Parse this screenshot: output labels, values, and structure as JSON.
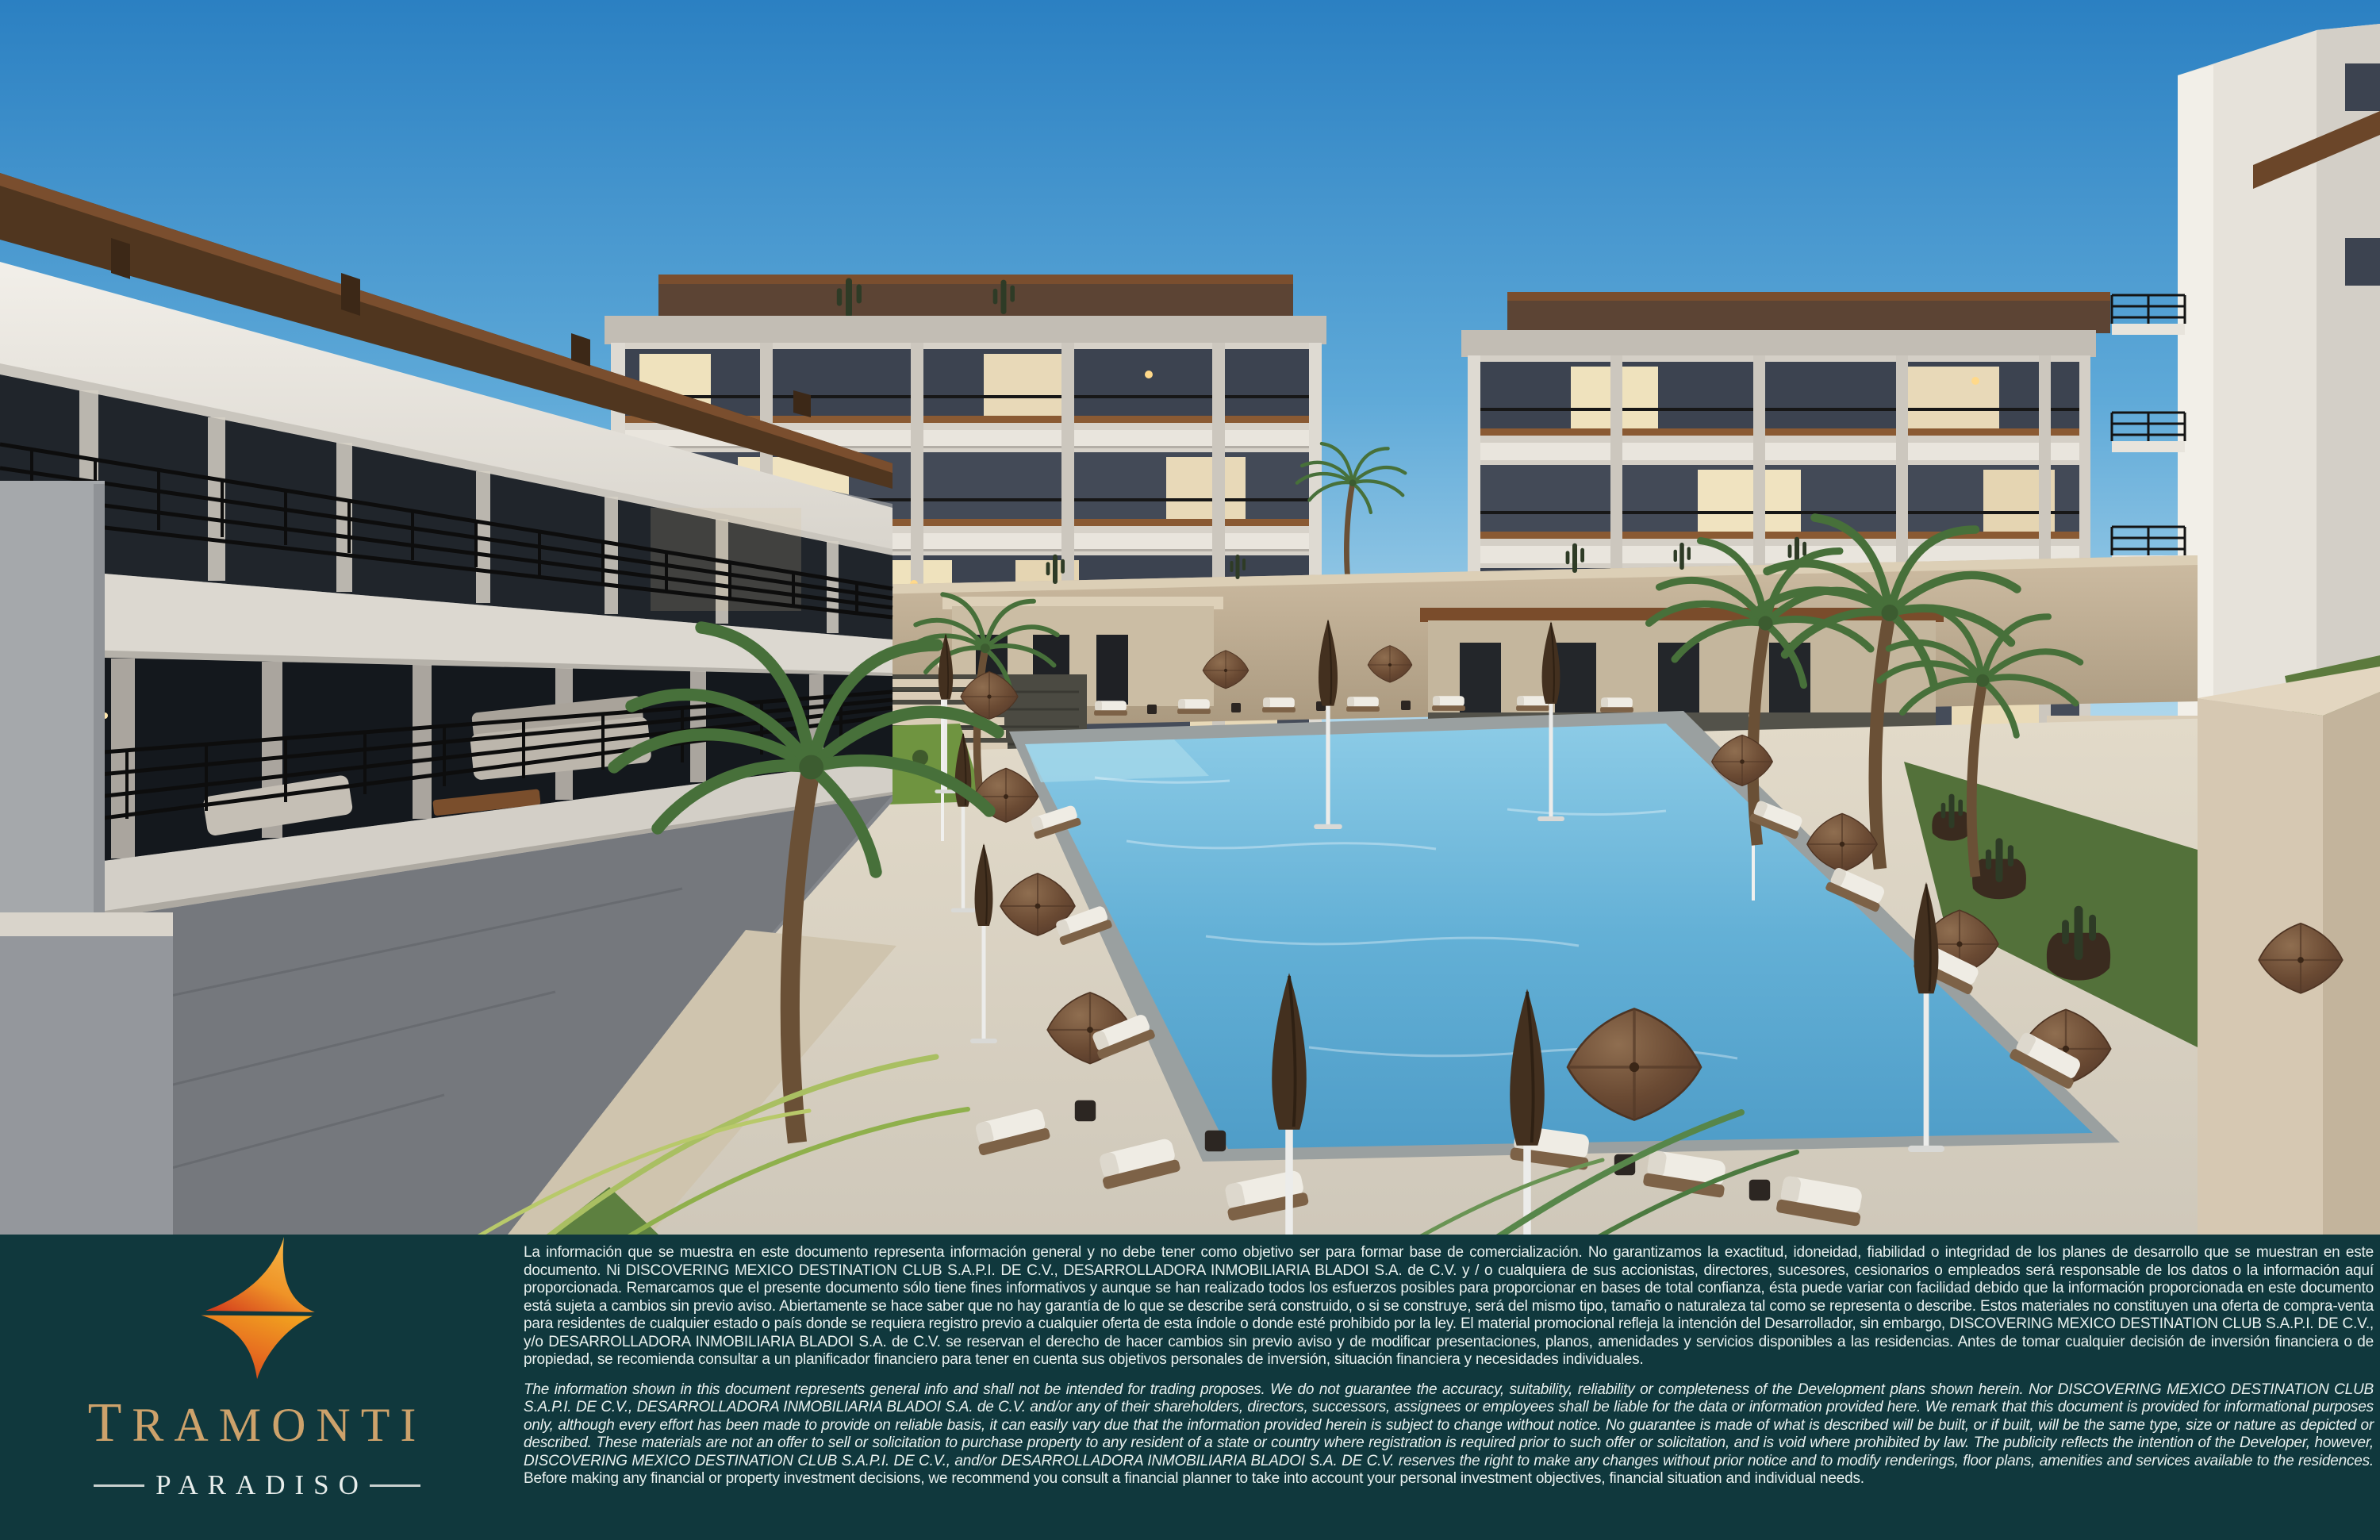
{
  "brand": {
    "name": "TRAMONTI",
    "tagline": "PARADISO"
  },
  "footer": {
    "disclaimer_es": "La información que se muestra en este documento representa información general y no debe tener como objetivo ser para formar base de comercialización. No garantizamos la exactitud, idoneidad, fiabilidad o integridad de los planes de desarrollo que se muestran en este documento.  Ni DISCOVERING MEXICO DESTINATION CLUB S.A.P.I. DE C.V., DESARROLLADORA INMOBILIARIA BLADOI S.A. de C.V. y / o cualquiera de sus accionistas, directores, sucesores, cesionarios o empleados será responsable de los datos o la información aquí proporcionada. Remarcamos que el presente documento sólo tiene fines informativos y aunque se han realizado todos los esfuerzos posibles para proporcionar en bases de total confianza, ésta puede variar con facilidad debido que la información proporcionada en este documento está sujeta a cambios sin previo aviso. Abiertamente se hace saber que no hay garantía de lo que se describe será construido, o si se construye, será del mismo tipo, tamaño o naturaleza tal como se representa o describe. Estos materiales no constituyen una oferta de compra-venta para residentes de cualquier estado o país donde se requiera registro previo a cualquier oferta de esta índole o donde esté prohibido por la ley. El material promocional refleja la intención del Desarrollador, sin embargo, DISCOVERING MEXICO DESTINATION CLUB S.A.P.I. DE C.V., y/o DESARROLLADORA INMOBILIARIA BLADOI S.A. de C.V. se reservan el derecho de hacer cambios sin previo aviso y de modificar presentaciones, planos, amenidades y servicios disponibles a las residencias. Antes de tomar cualquier decisión de inversión financiera o de propiedad, se recomienda consultar a un planificador financiero para tener en cuenta sus objetivos personales de inversión, situación financiera y necesidades individuales.",
    "disclaimer_en_italic": "The information shown in this document represents general info and shall not be intended for trading proposes. We do not guarantee the accuracy, suitability, reliability or completeness of the Development plans shown herein. Nor DISCOVERING MEXICO DESTINATION CLUB S.A.P.I. DE C.V., DESARROLLADORA INMOBILIARIA BLADOI S.A. de C.V. and/or any of their shareholders, directors, successors, assignees or employees shall be liable for the data or information provided here.  We remark that this document is provided for informational purposes only, although every effort has been made to provide on reliable basis, it can easily vary due that the information provided herein is subject to change without notice. No guarantee is made of what is described will be built, or if built, will be the same type, size or nature as depicted or described. These materials are not an offer to sell or solicitation to purchase property to any resident of a state or country where registration is required prior to such offer or solicitation, and is void where prohibited by law. The publicity reflects the intention of the Developer, however, DISCOVERING MEXICO DESTINATION CLUB S.A.P.I. DE C.V., and/or DESARROLLADORA INMOBILIARIA BLADOI S.A. DE C.V. reserves the right to make any changes without prior notice and to modify renderings, floor plans, amenities and services available to the residences.",
    "disclaimer_en_regular": "Before making any financial or property investment decisions, we recommend you consult a financial planner to take into account your personal investment objectives, financial situation and individual needs."
  },
  "scene": {
    "type": "architectural rendering",
    "elements": [
      "four-story condo buildings with rooftop pergolas",
      "courtyard swimming pool",
      "brown sun umbrellas",
      "white sun loungers",
      "palm trees",
      "stone retaining walls with cacti",
      "dusk sky"
    ]
  },
  "palette": {
    "footer_teal": "#10383d",
    "logo_orange": "#f2a51f",
    "logo_red": "#d1351c",
    "brand_gold": "#cda26b",
    "brand_silver": "#e7edeb",
    "sky_top": "#2b80c2",
    "sky_horizon": "#d8ecf6",
    "building_light": "#efece5",
    "building_shadow": "#83868b",
    "window_lit": "#efe2bd",
    "pool_water": "#5fb0d8",
    "deck": "#d8cfbd",
    "umbrella_brown": "#6a4a33",
    "palm_green": "#47703a",
    "wall_tan": "#c7b59b"
  }
}
